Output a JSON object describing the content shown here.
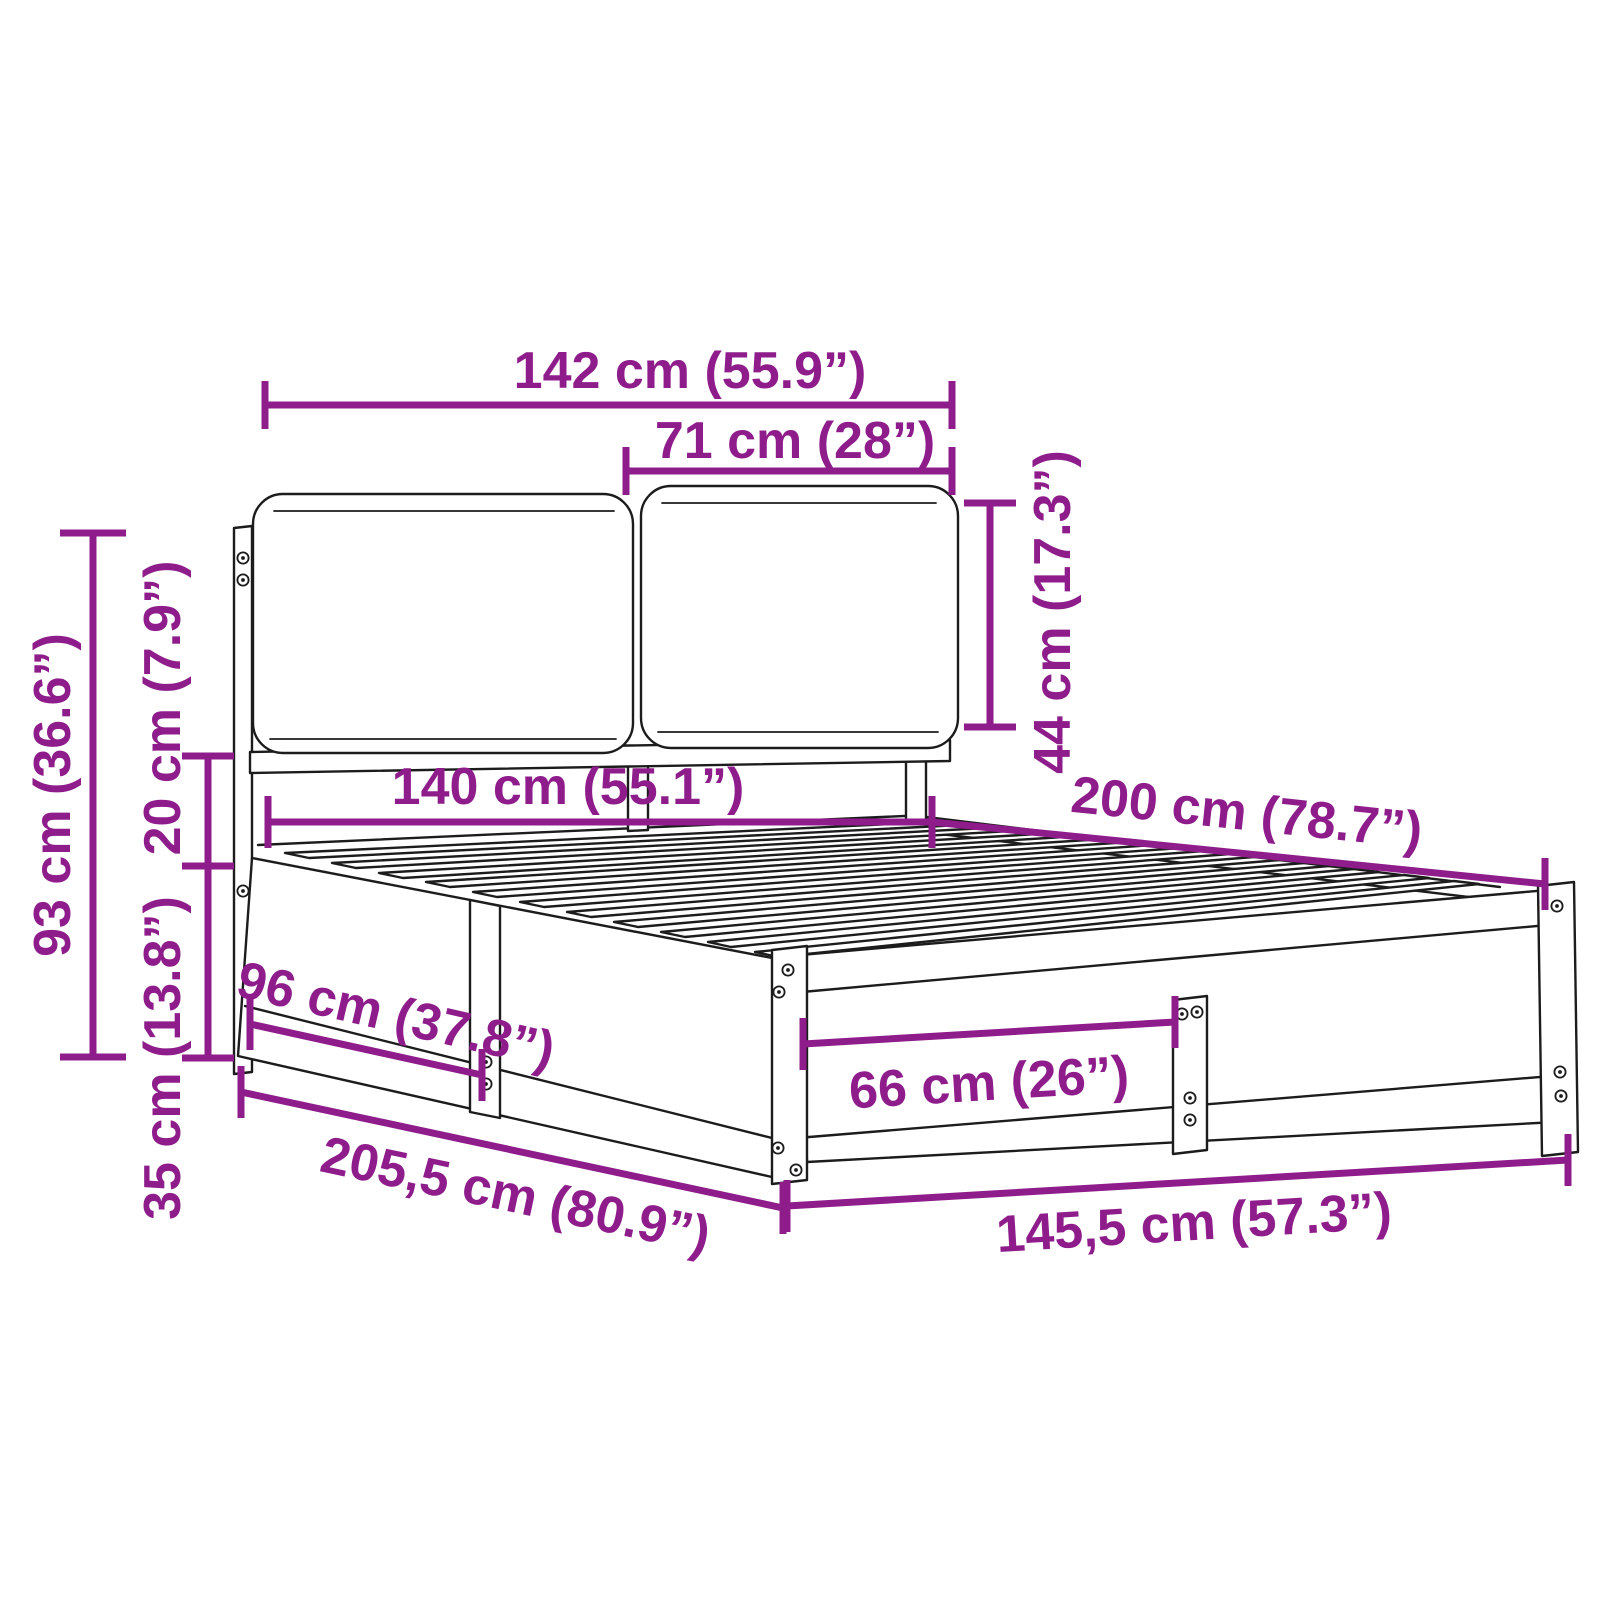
{
  "colors": {
    "annotation": "#8e1d8b",
    "sketch": "#1c1c1c",
    "background": "#ffffff"
  },
  "dimensions": {
    "headboard_width": "142 cm (55.9”)",
    "cushion_width": "71 cm (28”)",
    "cushion_height": "44 cm (17.3”)",
    "headboard_height": "93 cm (36.6”)",
    "cushion_gap": "20 cm (7.9”)",
    "frame_height": "35 cm (13.8”)",
    "mattress_width": "140 cm (55.1”)",
    "mattress_length": "200 cm (78.7”)",
    "side_leg_spacing": "96 cm (37.8”)",
    "foot_leg_spacing": "66 cm (26”)",
    "total_length": "205,5 cm (80.9”)",
    "total_width": "145,5 cm (57.3”)"
  }
}
